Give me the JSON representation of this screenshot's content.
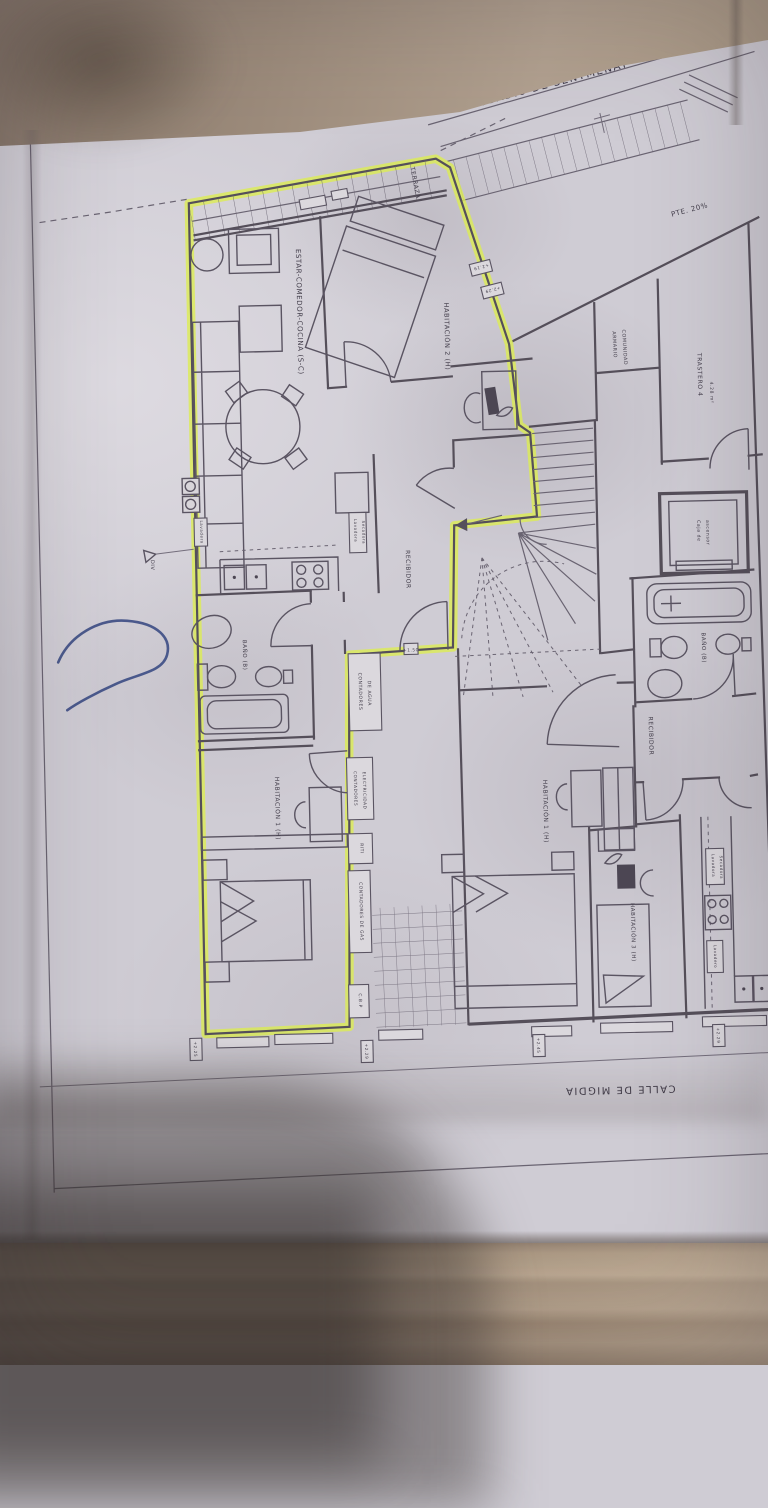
{
  "colors": {
    "highlight": "#dcec52",
    "pen": "#3c4c84",
    "paper": "#cfccd4",
    "wall": "#a5937f",
    "floor": "#a6937e",
    "ink": "#554f5a"
  },
  "streets": {
    "top": "PASSADIU DE SENTMENAT",
    "bottom": "CALLE DE MIGDIA",
    "ramp_slope": "PTE. 20%"
  },
  "left_apartment": {
    "terrace": "TERRAZA",
    "living": "ESTAR-COMEDOR-COCINA (S-C)",
    "bedroom2": "HABITACIÓN 2 (H)",
    "bedroom1": "HABITACIÓN 1 (H)",
    "hall": "RECIBIDOR",
    "bath": "BAÑO (B)",
    "laundry": "Lavadero",
    "washer": {
      "line1": "Lavadora",
      "line2": "Secadora"
    }
  },
  "right_apartment": {
    "bedroom1": "HABITACIÓN 1 (H)",
    "bedroom3": "HABITACIÓN 3 (H)",
    "hall": "RECIBIDOR",
    "bath": "BAÑO (B)",
    "laundry": "Lavadero",
    "washer": {
      "line1": "Lavadora",
      "line2": "Secadora"
    }
  },
  "common_areas": {
    "closet": {
      "line1": "ARMARIO",
      "line2": "COMUNIDAD"
    },
    "storage": {
      "name": "TRASTERO 4",
      "area": "4.28 m²"
    },
    "elevator": {
      "line1": "Caja de",
      "line2": "ascensor"
    }
  },
  "utility_boxes": {
    "water": {
      "line1": "CONTADORES",
      "line2": "DE AGUA"
    },
    "electricity": {
      "line1": "CONTADORES",
      "line2": "ELECTRICIDAD"
    },
    "riti": "RITI",
    "gas": "CONTADORES DE GAS",
    "cbp": "C.B.P"
  },
  "markers": {
    "div": "DIV",
    "ramp_a": "+2.19",
    "ramp_b": "+2.29",
    "hall": "+1.50",
    "bottom1": "+2.25",
    "bottom2": "+2.29",
    "bottom3": "+2.45",
    "bottom4": "+2.29"
  }
}
